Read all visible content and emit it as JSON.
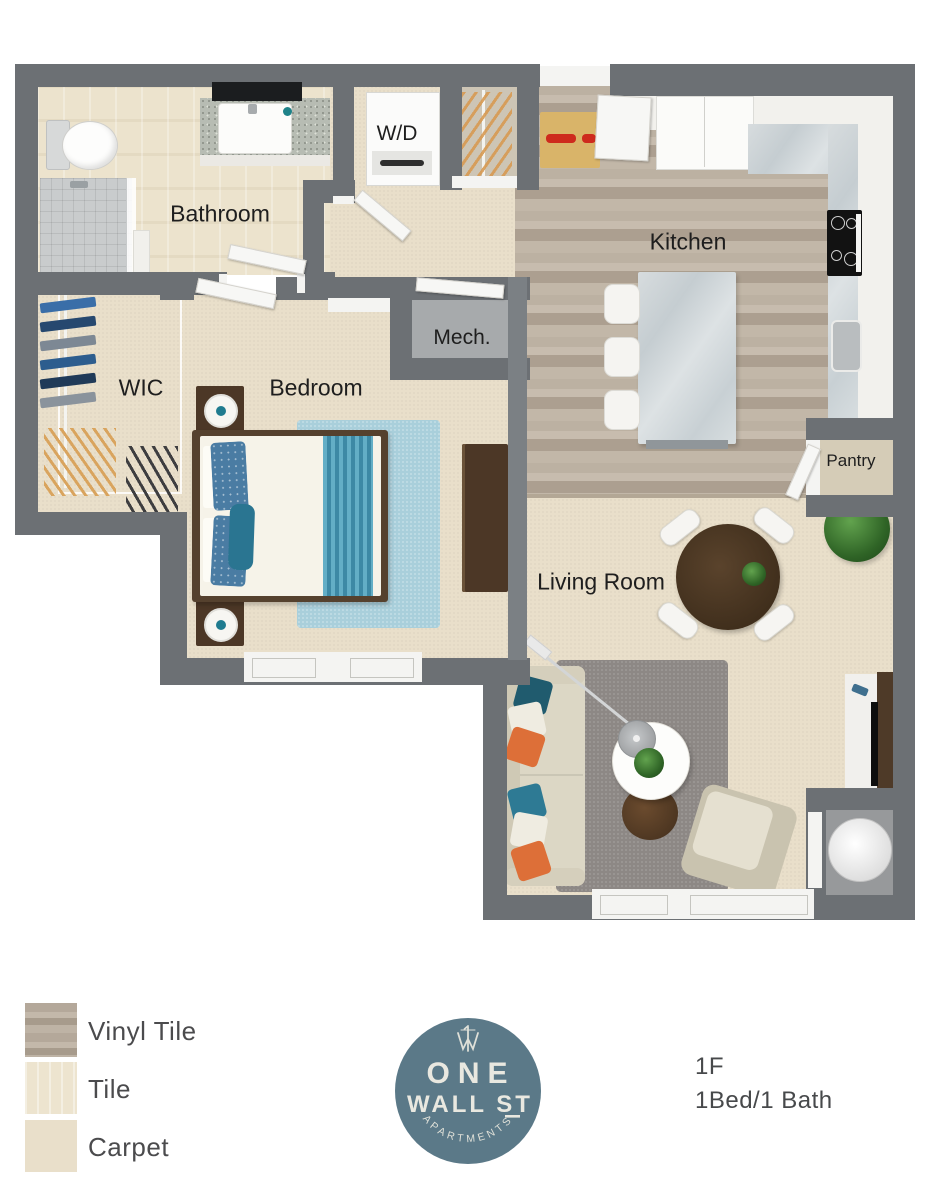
{
  "floorplan": {
    "rooms": {
      "bathroom": "Bathroom",
      "washer_dryer": "W/D",
      "kitchen": "Kitchen",
      "wic": "WIC",
      "bedroom": "Bedroom",
      "mech": "Mech.",
      "pantry": "Pantry",
      "living_room": "Living Room"
    }
  },
  "legend": {
    "items": [
      {
        "key": "vinyl-tile",
        "label": "Vinyl Tile"
      },
      {
        "key": "tile",
        "label": "Tile"
      },
      {
        "key": "carpet",
        "label": "Carpet"
      }
    ]
  },
  "logo": {
    "monogram": "1W",
    "line1": "ONE",
    "line2": "WALL ST",
    "subtext": "APARTMENTS"
  },
  "unit": {
    "floor": "1F",
    "type": "1Bed/1 Bath"
  },
  "colors": {
    "wall": "#6c7074",
    "vinyl_tile": "#bcb1a2",
    "tile": "#ece3cd",
    "carpet": "#e9dfca",
    "logo_blue": "#5b7988",
    "accent_teal": "#2e7a94",
    "accent_orange": "#dd6f38",
    "bedroom_rug_blue": "#a9cfdb",
    "living_rug_gray": "#8d8885"
  }
}
